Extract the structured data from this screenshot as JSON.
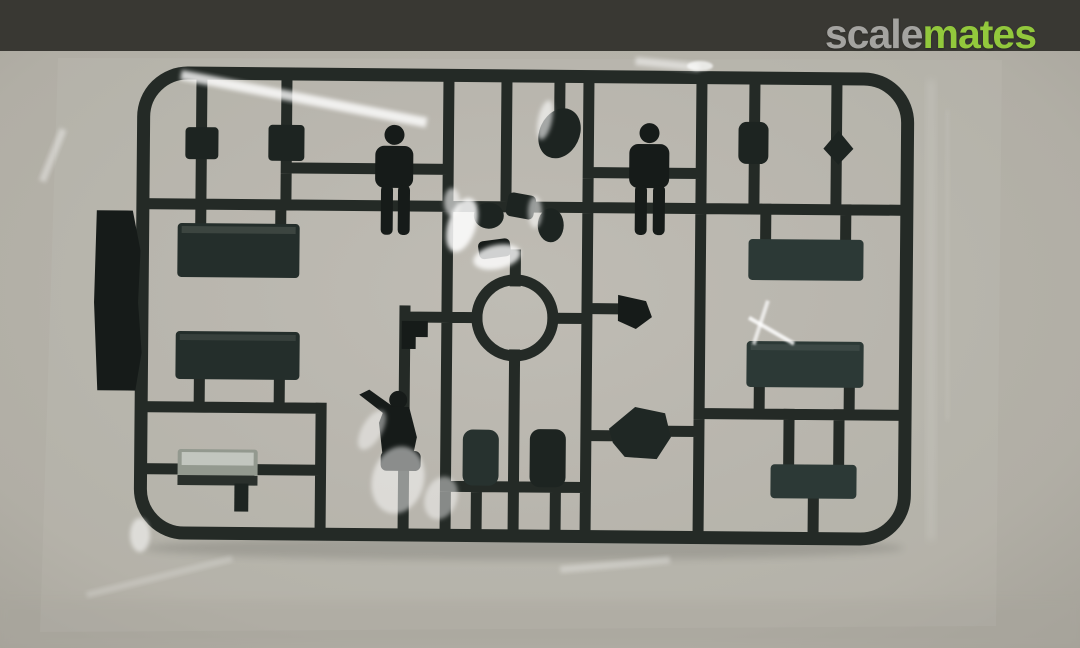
{
  "watermark": {
    "prefix": "scale",
    "suffix": "mates"
  },
  "colors": {
    "top-bar": "#393833",
    "backdrop": "#b3b0a7",
    "backdrop-edge": "#a5a299",
    "bag-sheen": "#ffffff",
    "sprue": "#242a26",
    "part-dark": "#1d2421",
    "part-black": "#161b19",
    "part-teal": "#2c3936",
    "part-light": "#93998f",
    "logo-prefix": "#a4a3a0",
    "logo-suffix": "#92c83c"
  },
  "photo": {
    "alt": "Dark green injection-molded sprue of plastic model kit parts sealed in a clear plastic bag on a grey surface"
  }
}
